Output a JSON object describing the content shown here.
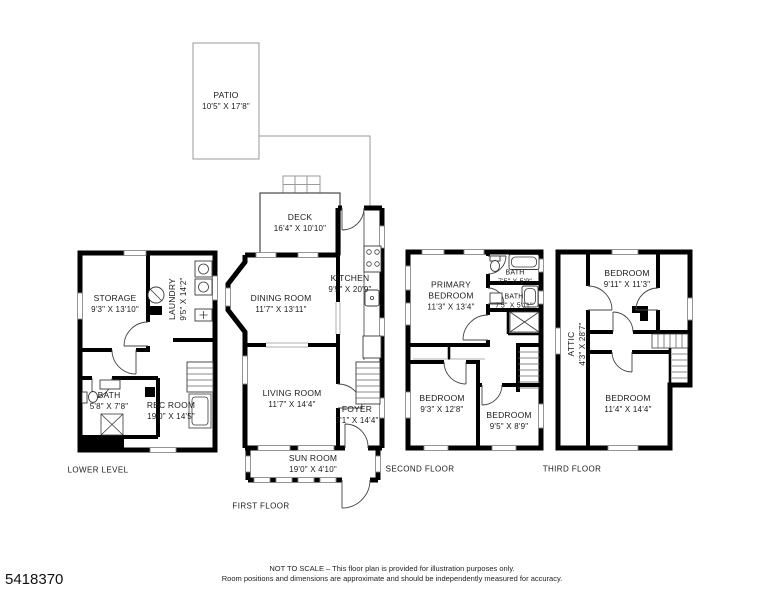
{
  "floors": {
    "lower_level": {
      "label": "LOWER LEVEL",
      "rooms": {
        "storage": {
          "name": "STORAGE",
          "dims": "9'3\" X 13'10\""
        },
        "laundry": {
          "name": "LAUNDRY",
          "dims": "9'5\" X 14'2\""
        },
        "bath": {
          "name": "BATH",
          "dims": "5'8\" X 7'8\""
        },
        "rec_room": {
          "name": "REC ROOM",
          "dims": "19'0\" X 14'5\""
        }
      }
    },
    "first_floor": {
      "label": "FIRST FLOOR",
      "rooms": {
        "patio": {
          "name": "PATIO",
          "dims": "10'5\" X 17'8\""
        },
        "deck": {
          "name": "DECK",
          "dims": "16'4\" X 10'10\""
        },
        "kitchen": {
          "name": "KITCHEN",
          "dims": "9'5\" X 20'9\""
        },
        "dining_room": {
          "name": "DINING ROOM",
          "dims": "11'7\" X 13'11\""
        },
        "living_room": {
          "name": "LIVING ROOM",
          "dims": "11'7\" X 14'4\""
        },
        "foyer": {
          "name": "FOYER",
          "dims": "7'1\" X 14'4\""
        },
        "sun_room": {
          "name": "SUN ROOM",
          "dims": "19'0\" X 4'10\""
        }
      }
    },
    "second_floor": {
      "label": "SECOND FLOOR",
      "rooms": {
        "primary_bedroom": {
          "name": "PRIMARY BEDROOM",
          "dims": "11'3\" X 13'4\""
        },
        "bath_1": {
          "name": "BATH",
          "dims": "7'5\" X 5'9\""
        },
        "bath_2": {
          "name": "BATH",
          "dims": "7'5\" X 5'11\""
        },
        "bedroom_left": {
          "name": "BEDROOM",
          "dims": "9'3\" X 12'8\""
        },
        "bedroom_right": {
          "name": "BEDROOM",
          "dims": "9'5\" X 8'9\""
        }
      }
    },
    "third_floor": {
      "label": "THIRD FLOOR",
      "rooms": {
        "bedroom_top": {
          "name": "BEDROOM",
          "dims": "9'11\" X 11'3\""
        },
        "attic": {
          "name": "ATTIC",
          "dims": "4'3\" X 28'7\""
        },
        "bedroom_bottom": {
          "name": "BEDROOM",
          "dims": "11'4\" X 14'4\""
        }
      }
    }
  },
  "footer": {
    "listing_id": "5418370",
    "disclaimer_line1": "NOT TO SCALE – This floor plan is provided for illustration purposes only.",
    "disclaimer_line2": "Room positions and dimensions are approximate and should be independently measured for accuracy."
  },
  "colors": {
    "wall": "#000000",
    "thin_line": "#9a9a9a",
    "text": "#1a1a1a",
    "background": "#ffffff"
  }
}
